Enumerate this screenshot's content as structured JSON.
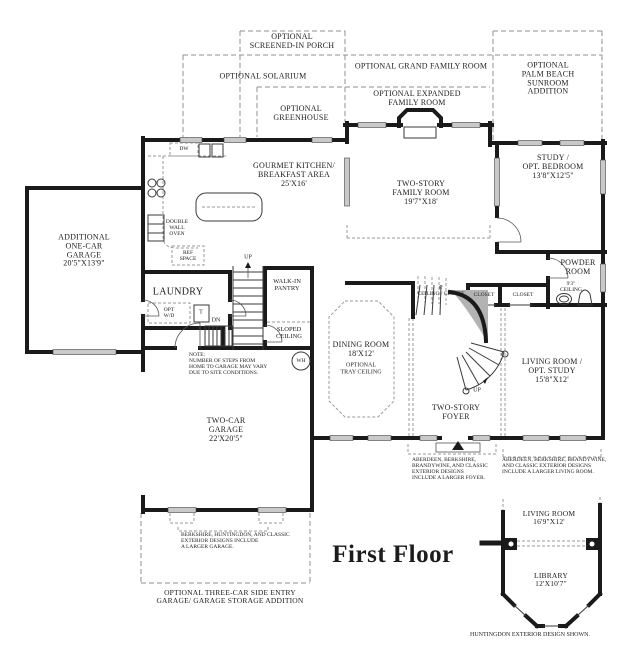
{
  "title": "First Floor",
  "colors": {
    "bg": "#ffffff",
    "wall": "#1a1a1a",
    "dashed": "#8f8f8f",
    "window": "#c9c9c9",
    "stair_fill": "#b3b3b3"
  },
  "optional": {
    "screened_porch": "OPTIONAL\nSCREENED-IN PORCH",
    "solarium": "OPTIONAL SOLARIUM",
    "grand_family": "OPTIONAL GRAND FAMILY ROOM",
    "expanded_family": "OPTIONAL EXPANDED\nFAMILY ROOM",
    "greenhouse": "OPTIONAL\nGREENHOUSE",
    "palm_beach": "OPTIONAL\nPALM BEACH SUNROOM\nADDITION",
    "three_car": "OPTIONAL THREE-CAR SIDE ENTRY\nGARAGE/ GARAGE STORAGE ADDITION"
  },
  "rooms": {
    "kitchen": {
      "label": "GOURMET KITCHEN/\nBREAKFAST AREA\n25'X16'"
    },
    "family": {
      "label": "TWO-STORY\nFAMILY ROOM\n19'7\"X18'"
    },
    "study": {
      "label": "STUDY /\nOPT. BEDROOM\n13'8\"X12'5\""
    },
    "one_car_garage": {
      "label": "ADDITIONAL\nONE-CAR\nGARAGE\n20'5\"X13'9\""
    },
    "laundry": {
      "label": "LAUNDRY"
    },
    "powder": {
      "label": "POWDER\nROOM",
      "sublabel": "9'3\"\nCEILING"
    },
    "dining": {
      "label": "DINING ROOM\n18'X12'",
      "sublabel": "OPTIONAL\nTRAY CEILING"
    },
    "foyer": {
      "label": "TWO-STORY\nFOYER"
    },
    "living": {
      "label": "LIVING ROOM /\nOPT. STUDY\n15'8\"X12'"
    },
    "two_car_garage": {
      "label": "TWO-CAR\nGARAGE\n22'X20'5\""
    },
    "pantry": {
      "label": "WALK-IN\nPANTRY"
    }
  },
  "small_labels": {
    "dw": "DW",
    "oven": "DOUBLE\nWALL\nOVEN",
    "ref": "REF\nSPACE",
    "opt_wd": "OPT\nW/D",
    "tub": "T",
    "wh": "WH",
    "up_back": "UP",
    "up_main": "UP",
    "dn": "DN",
    "sloped": "SLOPED\nCEILING",
    "understair": "8'\nCEILING / CLOSET",
    "closet_a": "CLOSET",
    "closet_b": "CLOSET"
  },
  "notes": {
    "steps": "NOTE:\nNUMBER OF STEPS FROM\nHOME TO GARAGE MAY VARY\nDUE TO SITE CONDITIONS.",
    "garage": "BERKSHIRE, HUNTINGDON, AND CLASSIC\nEXTERIOR DESIGNS INCLUDE\nA LARGER GARAGE.",
    "foyer": "ABERDEEN, BERKSHIRE,\nBRANDYWINE, AND CLASSIC\nEXTERIOR DESIGNS\nINCLUDE A LARGER FOYER.",
    "living": "ABERDEEN, BERKSHIRE, BRANDYWINE,\nAND CLASSIC EXTERIOR DESIGNS\nINCLUDE A LARGER LIVING ROOM.",
    "exterior": "HUNTINGDON EXTERIOR DESIGN SHOWN."
  },
  "inset": {
    "living": "LIVING ROOM\n16'9\"X12'",
    "library": "LIBRARY\n12'X10'7\""
  }
}
